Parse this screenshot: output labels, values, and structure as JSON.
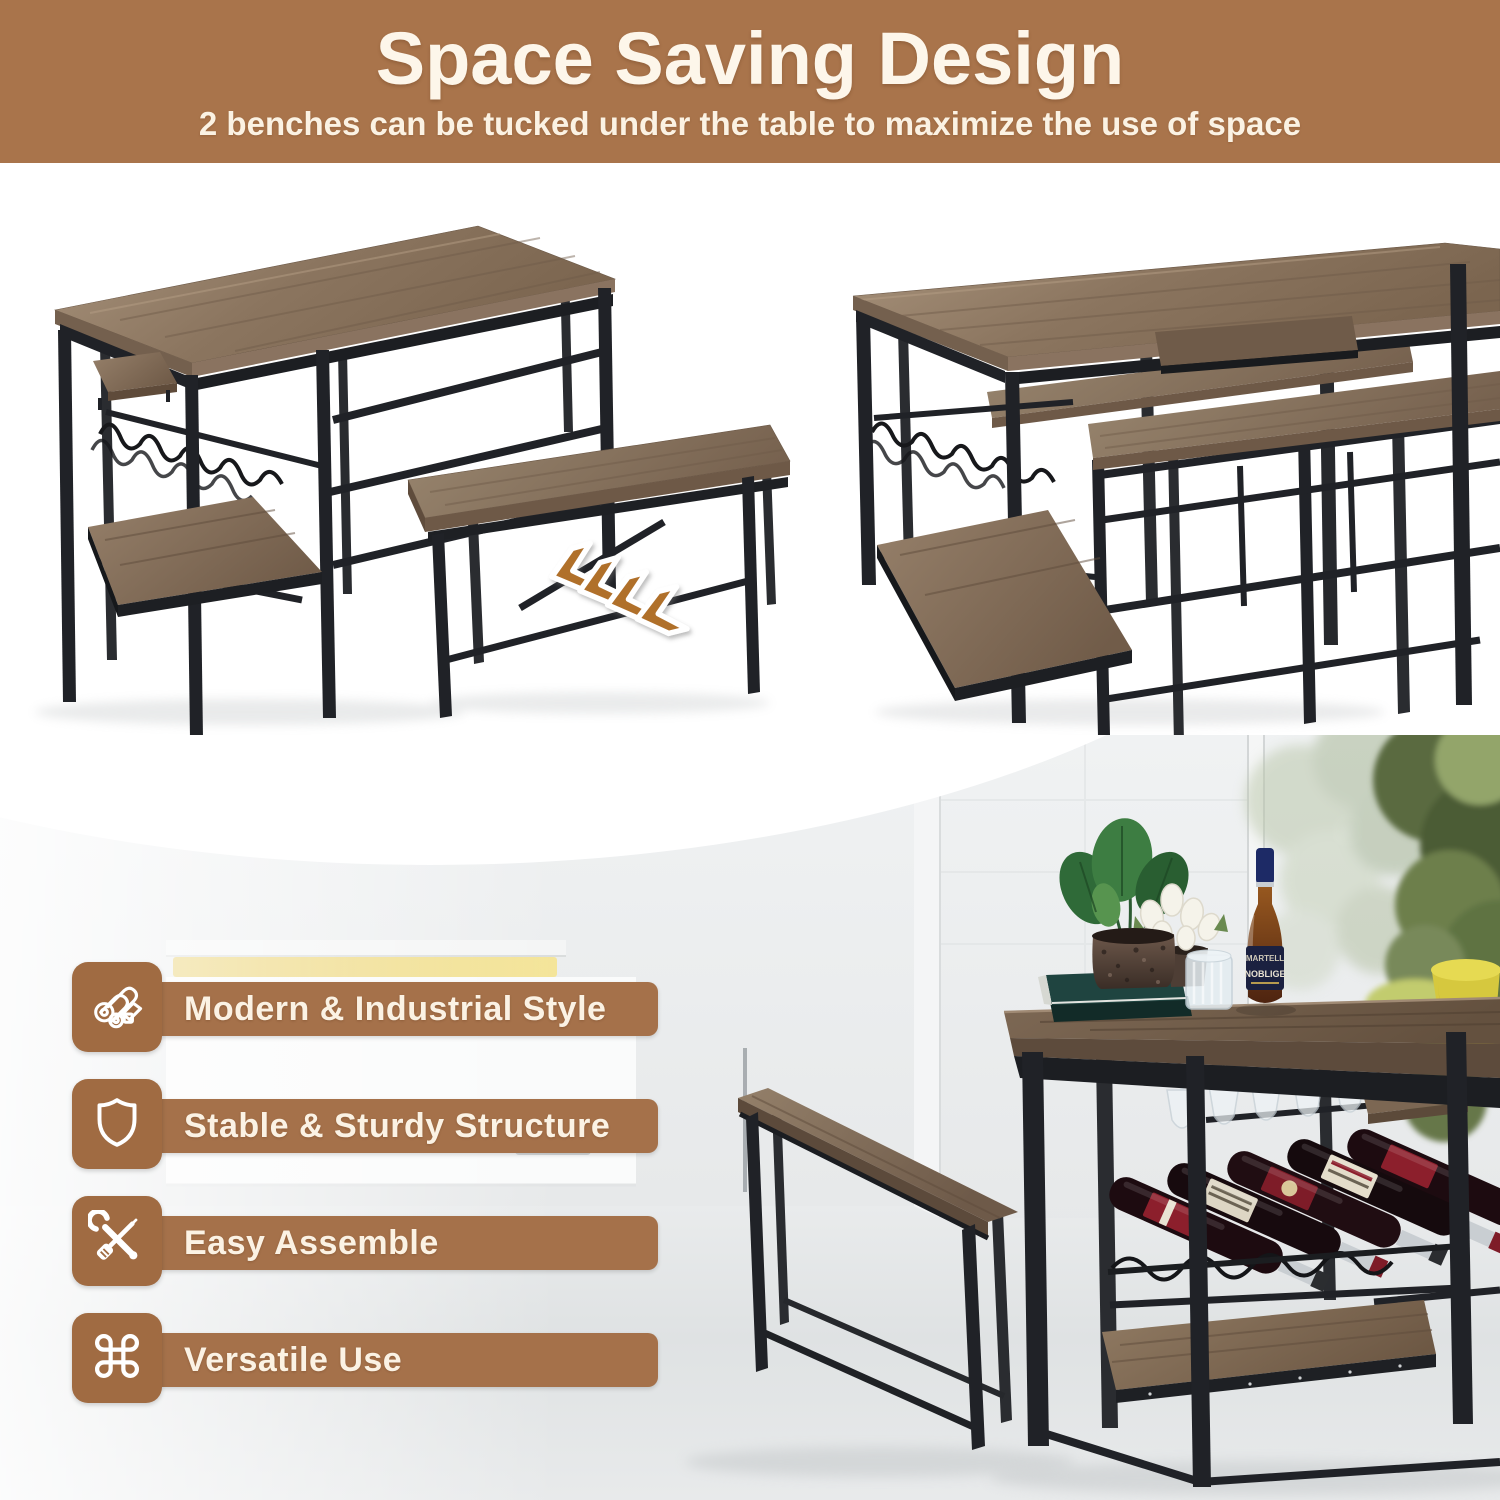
{
  "header": {
    "title": "Space Saving Design",
    "subtitle": "2 benches can be tucked under the table to maximize the use of space",
    "bg_color": "#a9744b",
    "text_color": "#fdf6ea"
  },
  "features": {
    "tile_color": "#a06b42",
    "bar_color": "#a5714a",
    "label_color": "#fbf2e4",
    "items": [
      {
        "icon": "lumber-icon",
        "label": "Modern & Industrial Style"
      },
      {
        "icon": "shield-icon",
        "label": "Stable & Sturdy Structure"
      },
      {
        "icon": "tools-icon",
        "label": "Easy Assemble"
      },
      {
        "icon": "command-icon",
        "label": "Versatile Use",
        "glyph": "⌘"
      }
    ]
  },
  "photos": {
    "left_product": {
      "name": "table-with-bench-pulled-out",
      "arrow_count": 4,
      "arrow_color": "#b0702c"
    },
    "right_product": {
      "name": "table-with-benches-tucked-under"
    },
    "lifestyle": {
      "name": "bar-table-set-in-kitchen",
      "bottle_text_1": "MARTELL",
      "bottle_text_2": "NOBLIGE"
    }
  },
  "palette": {
    "wood_light": "#a5907a",
    "wood_mid": "#87705b",
    "wood_dark": "#5e4c3d",
    "metal_black": "#202227",
    "floor_gray": "#e5e7e8",
    "accent_yellow": "#ecd26e"
  }
}
